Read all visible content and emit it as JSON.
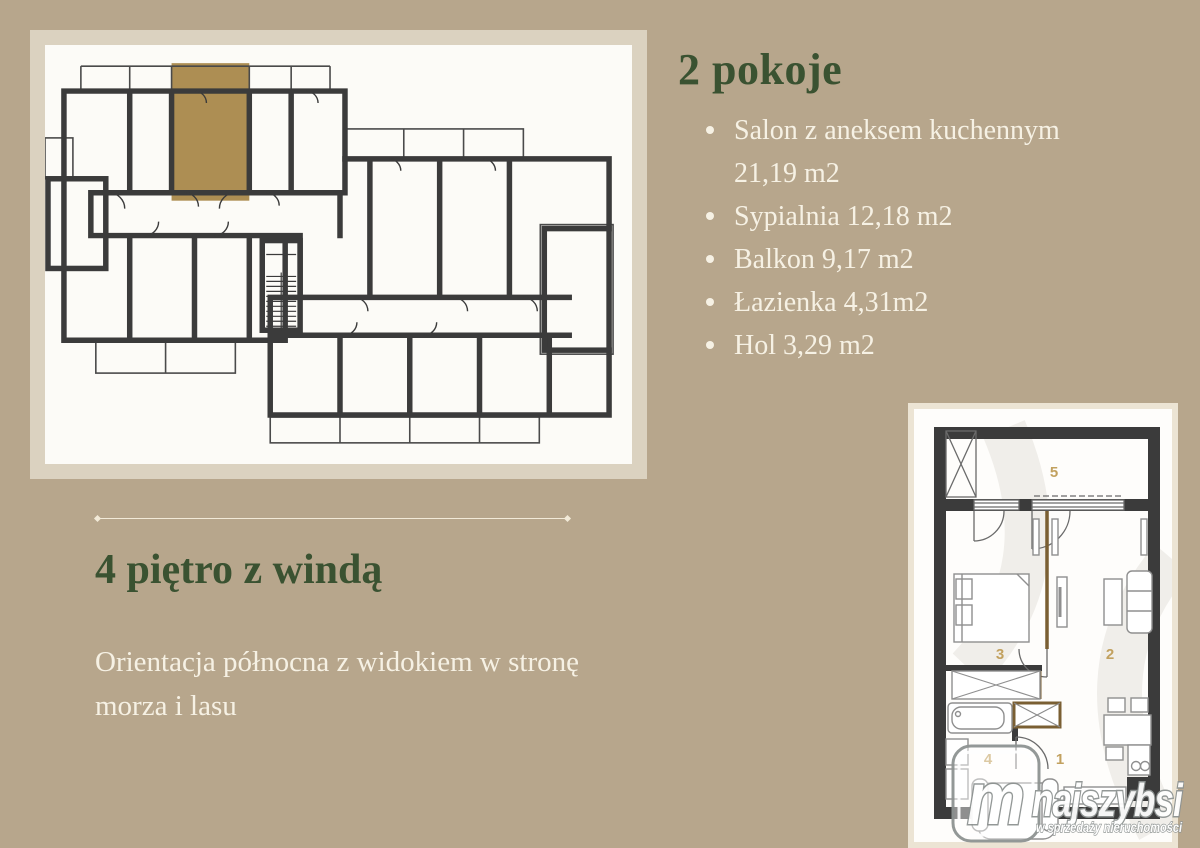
{
  "palette": {
    "background": "#b7a68c",
    "heading_green": "#3a5231",
    "text_cream": "#f6f1e4",
    "highlight_gold": "#ad8e53",
    "wall_dark": "#3b3b3b",
    "plan_accent_gold": "#7a5f33"
  },
  "unit_info": {
    "title": "2 pokoje",
    "items": [
      "Salon z aneksem kuchennym 21,19 m2",
      "Sypialnia 12,18 m2",
      "Balkon 9,17 m2",
      "Łazienka 4,31m2",
      "Hol 3,29 m2"
    ]
  },
  "floor_info": {
    "heading": "4 piętro z windą",
    "description": "Orientacja północna z widokiem w stronę morza i lasu"
  },
  "apartment_plan": {
    "room_numbers": [
      "1",
      "2",
      "3",
      "4",
      "5"
    ]
  },
  "logo": {
    "monogram": "m",
    "brand": "najszybsi",
    "tagline": "w sprzedaży nieruchomości"
  }
}
